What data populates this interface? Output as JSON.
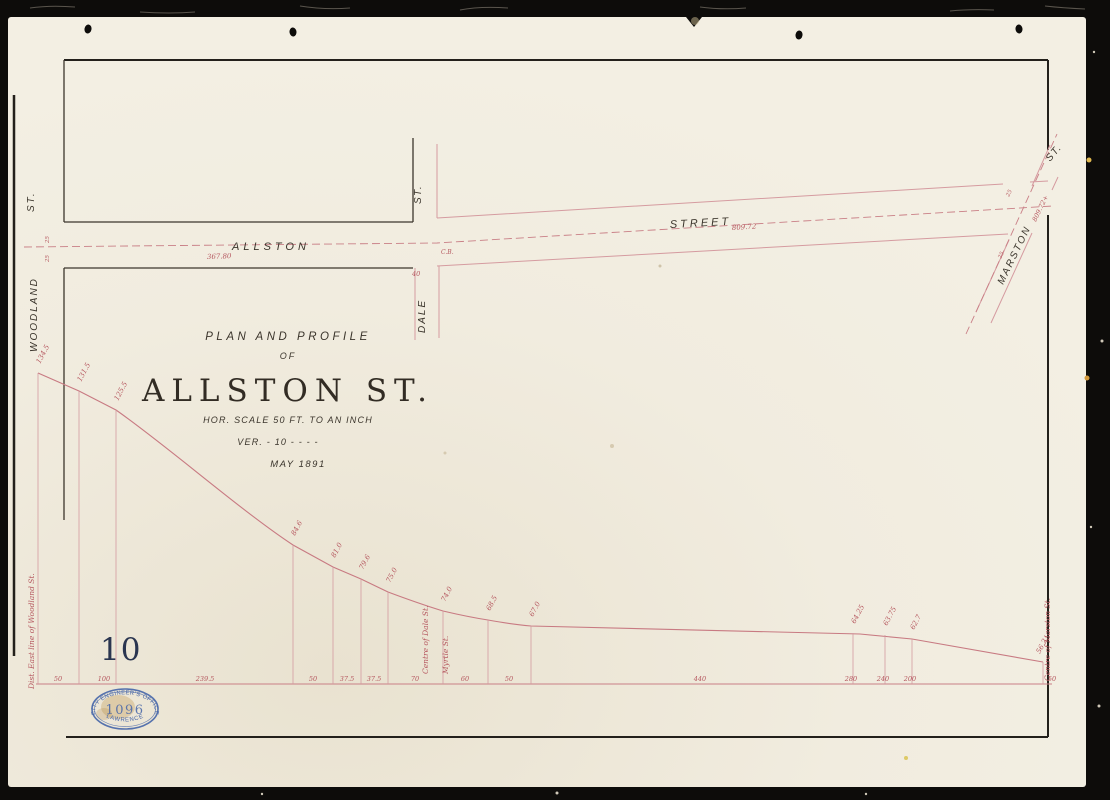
{
  "colors": {
    "paper": "#f1ecdf",
    "black_ink": "#3b352c",
    "red_ink": "#b5565e",
    "red_line": "#d59ba0",
    "stamp_blue": "#4565a8",
    "sheet_number_blue": "#2a3550",
    "scan_background": "#0d0c0a"
  },
  "sheet_number": "10",
  "title_block": {
    "line1": "PLAN AND PROFILE",
    "line2": "OF",
    "title": "ALLSTON ST.",
    "scale_horizontal": "HOR. SCALE 50 FT. TO AN INCH",
    "scale_vertical": "VER.  -  10  -  -  -  -",
    "date": "MAY 1891"
  },
  "plan": {
    "street_labels": {
      "woodland": "WOODLAND",
      "woodland_st": "ST.",
      "allston": "ALLSTON",
      "street": "STREET",
      "dale": "DALE",
      "dale_st": "ST.",
      "marston": "MARSTON",
      "marston_st": "ST."
    },
    "annotations": {
      "station_west": "367.80",
      "station_east": "809.72",
      "station_marston": "809.72+",
      "cb_dale": "C.B.",
      "width_dale": "40",
      "width_w1": "25",
      "width_w2": "25",
      "width_m1": "25",
      "width_m2": "25"
    }
  },
  "profile": {
    "elevation_labels": [
      "134.5",
      "131.5",
      "125.5",
      "84.6",
      "81.0",
      "79.6",
      "75.0",
      "74.0",
      "68.5",
      "67.0",
      "64.25",
      "63.75",
      "62.7",
      "56.2"
    ],
    "distance_labels": [
      "50",
      "100",
      "239.5",
      "50",
      "37.5",
      "37.5",
      "70",
      "60",
      "50",
      "440",
      "280",
      "240",
      "200",
      "50"
    ],
    "notes": {
      "left": "Dist. East line of Woodland St.",
      "dale": "Centre of Dale St.",
      "myrtle": "Myrtle St.",
      "marston": "Centre of Marston St."
    }
  },
  "stamp": {
    "arc_top": "CITY ENGINEER'S OFFICE",
    "number": "1096",
    "arc_bottom": "LAWRENCE"
  }
}
